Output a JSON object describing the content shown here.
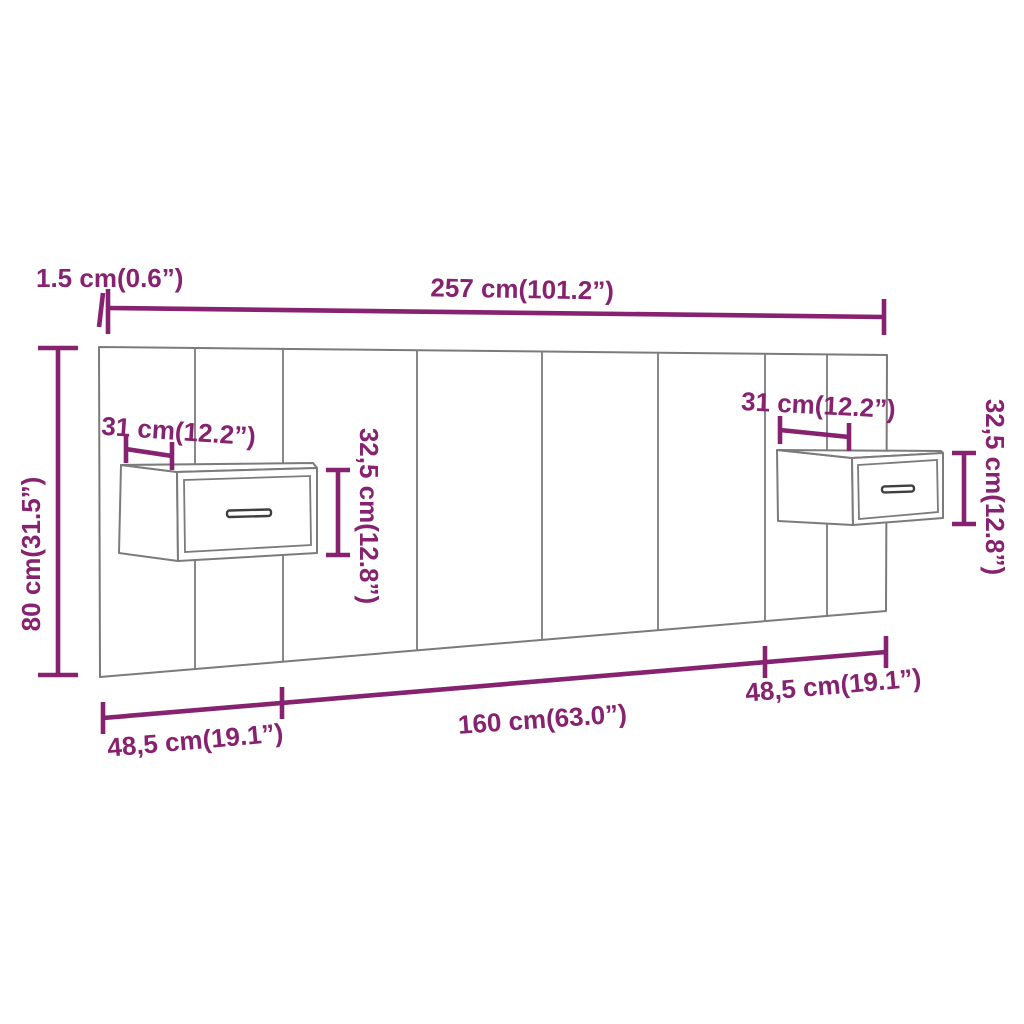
{
  "diagram": {
    "subject": "wall headboard with two floating bedside cabinets",
    "colors": {
      "dimension": "#86226f",
      "furniture_outline": "#7b7b7b",
      "handle": "#3f3f3f",
      "background": "#ffffff"
    },
    "labels": {
      "thickness": "1.5 cm(0.6”)",
      "total_width": "257 cm(101.2”)",
      "total_height": "80 cm(31.5”)",
      "left_cabinet_depth": "31 cm(12.2”)",
      "left_cabinet_height": "32,5 cm(12.8”)",
      "right_cabinet_depth": "31 cm(12.2”)",
      "right_cabinet_height": "32,5 cm(12.8”)",
      "bottom_left_section": "48,5 cm(19.1”)",
      "bottom_middle_section": "160 cm(63.0”)",
      "bottom_right_section": "48,5 cm(19.1”)"
    }
  }
}
